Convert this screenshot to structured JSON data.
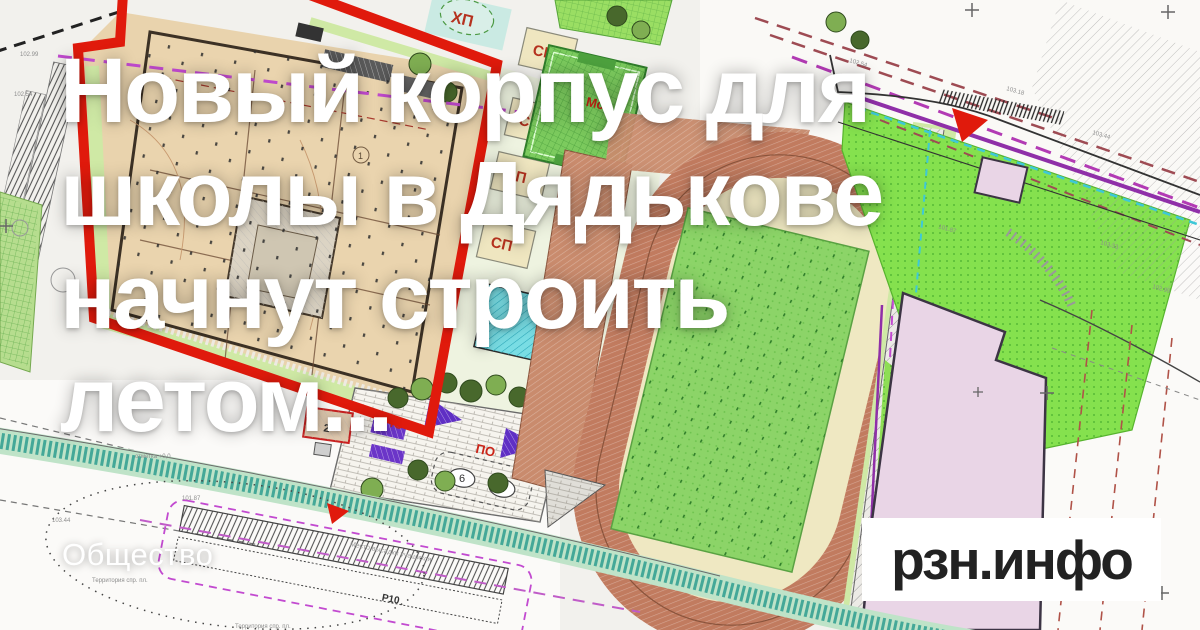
{
  "page": {
    "title_line1": "Новый корпус для",
    "title_line2": "школы в Дядькове",
    "title_line3": "начнут строить",
    "title_line4": "летом...",
    "category": "Общество",
    "brand": "рзн.инфо"
  },
  "map": {
    "labels": {
      "hp": "ХП",
      "sp1": "СП",
      "sp2": "СП",
      "sp3": "СП",
      "sp4": "СП",
      "ms": "Мс",
      "po1": "ПО",
      "po2": "ПО",
      "bld2": "2",
      "bld1": "1",
      "num6": "6",
      "num4": "4",
      "p10": "Р10",
      "note_dropoff": "Место высадки учащихся",
      "note_territory": "Территория спр. пл.",
      "note_territory2": "Территория спр. пл.",
      "note_mark": "отметка +0,0"
    },
    "elevations": [
      "102.54",
      "103.18",
      "103.44",
      "101.87",
      "103.33",
      "102.99"
    ],
    "colors": {
      "accent_red": "#e01a0c",
      "beige_building": "#e9d3ad",
      "track": "#c17b5f",
      "infield_cream": "#efe8c2",
      "field_green": "#8cd468",
      "lawn_green": "#85e14e",
      "pink_building": "#e9d5e6",
      "court_cyan": "#79dde4",
      "verge_green": "#cfe9a5",
      "purple_line": "#8f2fa8",
      "magenta_dash": "#c24ad0",
      "brand_text": "#222222"
    }
  }
}
